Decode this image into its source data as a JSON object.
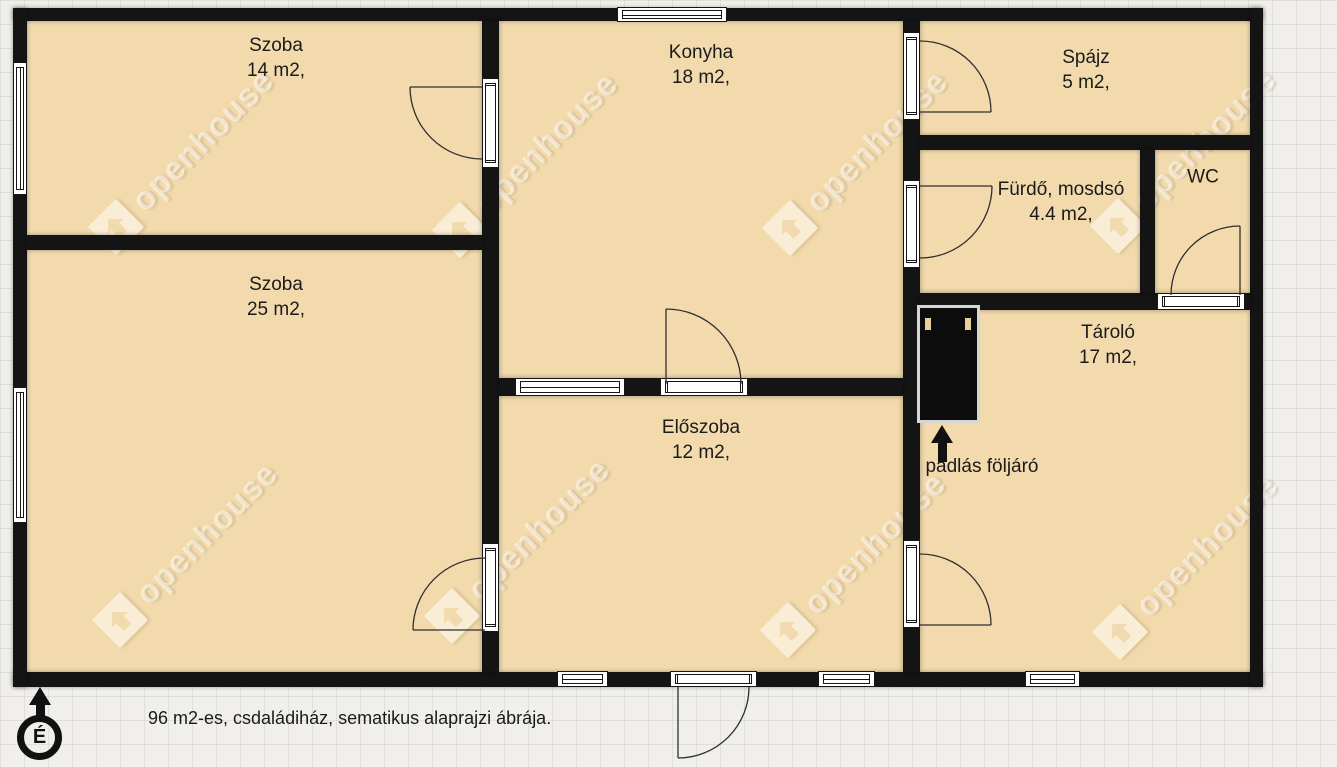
{
  "caption": {
    "text": "96 m2-es, csdaládiház, sematikus alaprajzi ábrája."
  },
  "north": {
    "label": "É",
    "icon": "north-arrow-icon"
  },
  "watermark": {
    "text": "openhouse",
    "icon": "openhouse-diamond-logo",
    "centers": [
      [
        116,
        227
      ],
      [
        460,
        230
      ],
      [
        790,
        228
      ],
      [
        1118,
        226
      ],
      [
        120,
        620
      ],
      [
        452,
        616
      ],
      [
        788,
        630
      ],
      [
        1120,
        632
      ]
    ]
  },
  "colors": {
    "background": "#f0efeb",
    "grid_line": "#e1e0d9",
    "room_fill": "#f2daad",
    "wall": "#141414",
    "label_text": "#1b1b1b",
    "watermark_text": "rgba(255,255,255,0.5)"
  },
  "plan": {
    "footprint": {
      "x": 13,
      "y": 8,
      "w": 1250,
      "h": 679
    },
    "rooms": [
      {
        "id": "szoba-14",
        "name": "Szoba",
        "area": "14 m2,",
        "cx": 276,
        "cy": 58
      },
      {
        "id": "szoba-25",
        "name": "Szoba",
        "area": "25 m2,",
        "cx": 276,
        "cy": 297
      },
      {
        "id": "konyha",
        "name": "Konyha",
        "area": "18 m2,",
        "cx": 701,
        "cy": 65
      },
      {
        "id": "eloszoba",
        "name": "Előszoba",
        "area": "12 m2,",
        "cx": 701,
        "cy": 440
      },
      {
        "id": "spajz",
        "name": "Spájz",
        "area": "5 m2,",
        "cx": 1086,
        "cy": 70
      },
      {
        "id": "furdo",
        "name": "Fürdő, mosdsó",
        "area": "4.4 m2,",
        "cx": 1061,
        "cy": 202
      },
      {
        "id": "wc",
        "name": "WC",
        "area": "",
        "cx": 1203,
        "cy": 177
      },
      {
        "id": "tarolo",
        "name": "Tároló",
        "area": "17 m2,",
        "cx": 1108,
        "cy": 345
      }
    ],
    "walls": [
      [
        13,
        8,
        1250,
        13
      ],
      [
        13,
        672,
        1250,
        15
      ],
      [
        13,
        8,
        14,
        679
      ],
      [
        1250,
        8,
        13,
        679
      ],
      [
        482,
        21,
        17,
        651
      ],
      [
        27,
        235,
        455,
        15
      ],
      [
        903,
        21,
        17,
        651
      ],
      [
        499,
        378,
        404,
        18
      ],
      [
        920,
        135,
        330,
        15
      ],
      [
        920,
        293,
        330,
        17
      ],
      [
        1140,
        150,
        15,
        143
      ]
    ],
    "windows": [
      {
        "x": 13,
        "y": 62,
        "w": 14,
        "h": 133,
        "o": "v"
      },
      {
        "x": 13,
        "y": 387,
        "w": 14,
        "h": 136,
        "o": "v"
      },
      {
        "x": 617,
        "y": 7,
        "w": 110,
        "h": 15,
        "o": "h"
      },
      {
        "x": 557,
        "y": 671,
        "w": 51,
        "h": 16,
        "o": "h"
      },
      {
        "x": 818,
        "y": 671,
        "w": 57,
        "h": 16,
        "o": "h"
      },
      {
        "x": 1025,
        "y": 671,
        "w": 55,
        "h": 16,
        "o": "h"
      },
      {
        "x": 515,
        "y": 378,
        "w": 110,
        "h": 18,
        "o": "h"
      }
    ],
    "door_openings": [
      {
        "x": 482,
        "y": 78,
        "w": 17,
        "h": 90,
        "o": "v"
      },
      {
        "x": 482,
        "y": 543,
        "w": 17,
        "h": 89,
        "o": "v"
      },
      {
        "x": 660,
        "y": 378,
        "w": 88,
        "h": 18,
        "o": "h"
      },
      {
        "x": 903,
        "y": 32,
        "w": 17,
        "h": 88,
        "o": "v"
      },
      {
        "x": 903,
        "y": 180,
        "w": 17,
        "h": 88,
        "o": "v"
      },
      {
        "x": 903,
        "y": 540,
        "w": 17,
        "h": 88,
        "o": "v"
      },
      {
        "x": 1157,
        "y": 293,
        "w": 88,
        "h": 17,
        "o": "h"
      },
      {
        "x": 670,
        "y": 671,
        "w": 87,
        "h": 16,
        "o": "h"
      }
    ],
    "door_swings": [
      {
        "leaf": "M482 87 L410 87",
        "arc": "M410 87 A72 72 0 0 0 482 159"
      },
      {
        "leaf": "M485 630 L413 630",
        "arc": "M485 558 A72 72 0 0 0 413 630"
      },
      {
        "leaf": "M666 384 L666 309",
        "arc": "M666 309 A75 75 0 0 1 741 384"
      },
      {
        "leaf": "M920 112 L991 112",
        "arc": "M920 41 A71 71 0 0 1 991 112"
      },
      {
        "leaf": "M920 186 L992 186",
        "arc": "M992 186 A72 72 0 0 1 920 258"
      },
      {
        "leaf": "M920 625 L991 625",
        "arc": "M920 554 A71 71 0 0 1 991 625"
      },
      {
        "leaf": "M1240 295 L1240 226",
        "arc": "M1240 226 A69 69 0 0 0 1171 295"
      },
      {
        "leaf": "M678 687 L678 758",
        "arc": "M678 758 A71 71 0 0 0 749 687"
      }
    ],
    "attic": {
      "label": "padlás följáró",
      "hatch": {
        "x": 917,
        "y": 305,
        "w": 63,
        "h": 118
      }
    }
  }
}
